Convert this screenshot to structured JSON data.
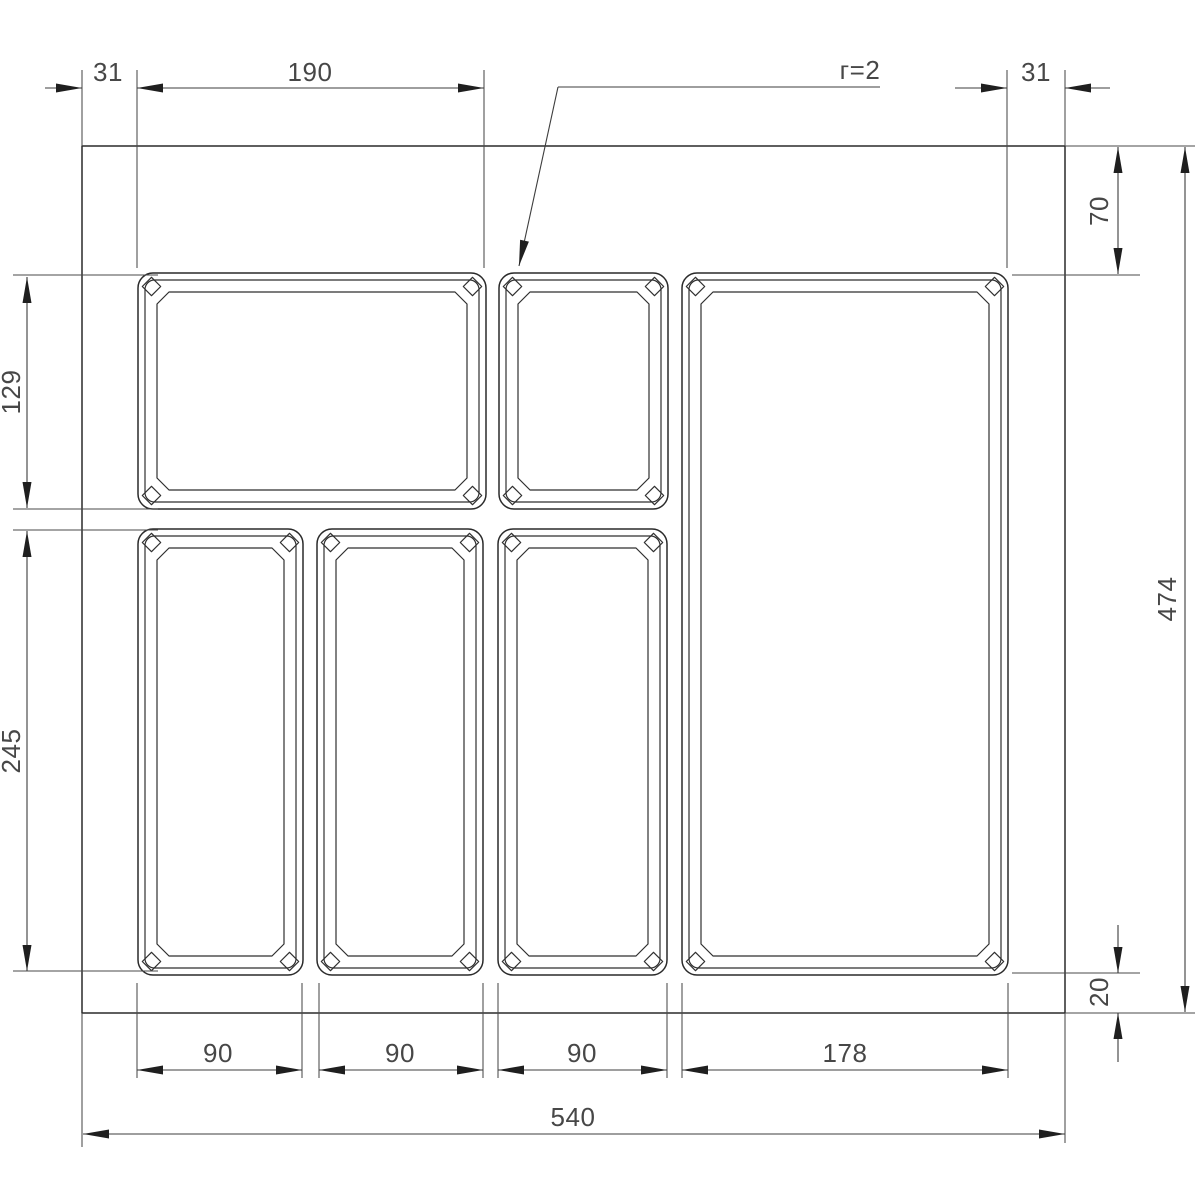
{
  "drawing": {
    "dims": {
      "top": [
        {
          "label": "31"
        },
        {
          "label": "190"
        },
        {
          "label": "31"
        }
      ],
      "radius_note": {
        "label": "г=2"
      },
      "left": [
        {
          "label": "129"
        },
        {
          "label": "245"
        }
      ],
      "right": [
        {
          "label": "70"
        },
        {
          "label": "474"
        },
        {
          "label": "20"
        }
      ],
      "bottom": [
        {
          "label": "90"
        },
        {
          "label": "90"
        },
        {
          "label": "90"
        },
        {
          "label": "178"
        }
      ],
      "total_width": {
        "label": "540"
      }
    }
  }
}
